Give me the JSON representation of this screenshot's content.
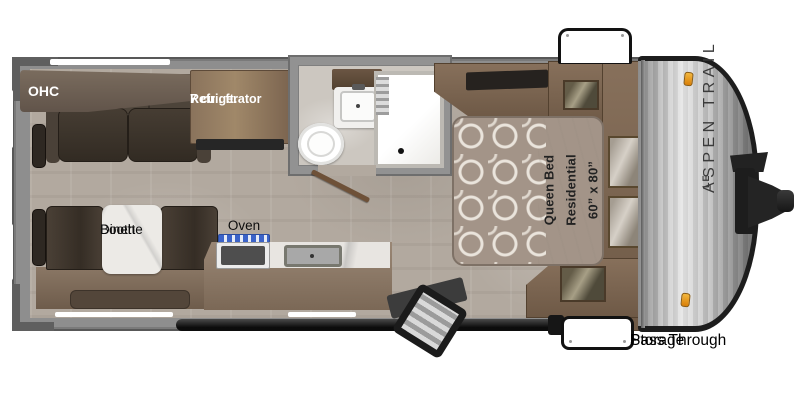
{
  "floorplan": {
    "brand": {
      "name": "ASPEN TRAIL",
      "badge": "LE"
    },
    "labels": {
      "ohc": "OHC",
      "refrigerator": [
        "7 cu . ft.",
        "Refrigerator"
      ],
      "dinette": [
        "Booth",
        "Dinette"
      ],
      "oven": "Oven",
      "bed": [
        "60” x 80”",
        "Residential",
        "Queen Bed"
      ],
      "pass_through": [
        "Pass Through",
        "Storage"
      ]
    },
    "colors": {
      "floor": "#b2a99f",
      "wall_gray": "#8e8e8e",
      "wood": "#7f6955",
      "dark_upholstery": "#3b332b",
      "marble": "#eceae6",
      "bedspread": "#a39488",
      "burner_blue": "#3b63c9",
      "marker_amber": "#e8940e",
      "cap_metal": "#c0c0c0"
    }
  }
}
